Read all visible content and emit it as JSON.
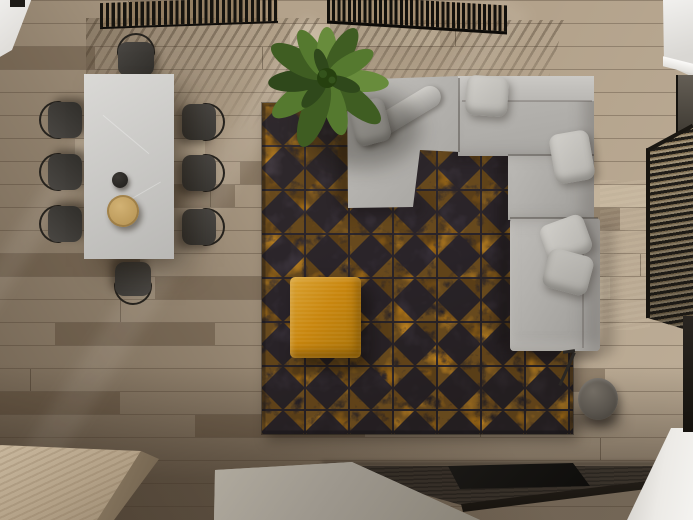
{
  "scene": {
    "type": "interior-3d-render",
    "view": "top-down",
    "room": "living-and-dining-area",
    "visible_text": ""
  },
  "palette": {
    "floorBase": "#b3a28b",
    "white": "#efeeec",
    "whiteDim": "#d9d7d3",
    "rugBase": "#3a3236",
    "rugBaseDark": "#2b2427",
    "rugAccent": "#c8891f",
    "rugAccent2": "#a96f12",
    "ottoman": "#c8860e",
    "ottomanLight": "#daa231",
    "ottomanDark": "#a87208",
    "sofaLight": "#c6c4c0",
    "sofaMid": "#b4b2ae",
    "sofaDark": "#a3a19d",
    "pillow": "#d2d0cb",
    "tableLight": "#dad9d6",
    "tableDark": "#b9b8b5",
    "chairSeat": "#4a4743",
    "chairSeatDark": "#312f2b",
    "chairFrame": "#26231e",
    "plate": "#b18e4e",
    "teapot": "#201e1b",
    "plantDark": "#2f481b",
    "plantMid": "#3f5d22",
    "plantLight": "#688c3c",
    "plantPale": "#55792f",
    "plantCore": "#26400f",
    "lampLight": "#736d64",
    "lampDark": "#403c36",
    "lampArm": "#2a2724",
    "consoleTop": "#332c25",
    "consoleFront": "#17130e",
    "tvBlack": "#0e0d0b",
    "concrete": "#9d978d",
    "concreteLight": "#b0aa9e",
    "bench": "#b3a187",
    "benchSide": "#6e5f4b",
    "glass": "#645e55",
    "slatGap": "#a08a66",
    "blindDark": "#17140f"
  },
  "objects": [
    {
      "name": "wood-floor",
      "label": "oak plank flooring with sunlight streaks"
    },
    {
      "name": "slatted-screen-left",
      "label": "black slatted ceiling screen"
    },
    {
      "name": "slatted-screen-right",
      "label": "black slatted ceiling screen"
    },
    {
      "name": "dining-table",
      "label": "white marble dining table"
    },
    {
      "name": "dining-chairs",
      "label": "eight dark upholstered chairs"
    },
    {
      "name": "serving-plate",
      "label": "round tan plate"
    },
    {
      "name": "black-teapot",
      "label": "small black teapot"
    },
    {
      "name": "area-rug",
      "label": "charcoal rug with distressed amber triangle pattern"
    },
    {
      "name": "sofa-sectional",
      "label": "light grey L-shaped sectional sofa with pillows"
    },
    {
      "name": "ottoman-pouf",
      "label": "mustard yellow square pouf"
    },
    {
      "name": "potted-plant",
      "label": "large green banana-leaf plant"
    },
    {
      "name": "floor-lamp",
      "label": "grey drum floor lamp"
    },
    {
      "name": "media-console",
      "label": "dark wood low media console"
    },
    {
      "name": "tv-flat",
      "label": "flat black screen on console"
    },
    {
      "name": "concrete-block",
      "label": "grey stone block"
    },
    {
      "name": "wood-bench",
      "label": "light wood block bench"
    },
    {
      "name": "window-blinds",
      "label": "dark horizontal window blinds"
    },
    {
      "name": "white-cabinet-top-right",
      "label": "white cabinet corner"
    },
    {
      "name": "white-floor-corner",
      "label": "white floor patch bottom right"
    }
  ]
}
